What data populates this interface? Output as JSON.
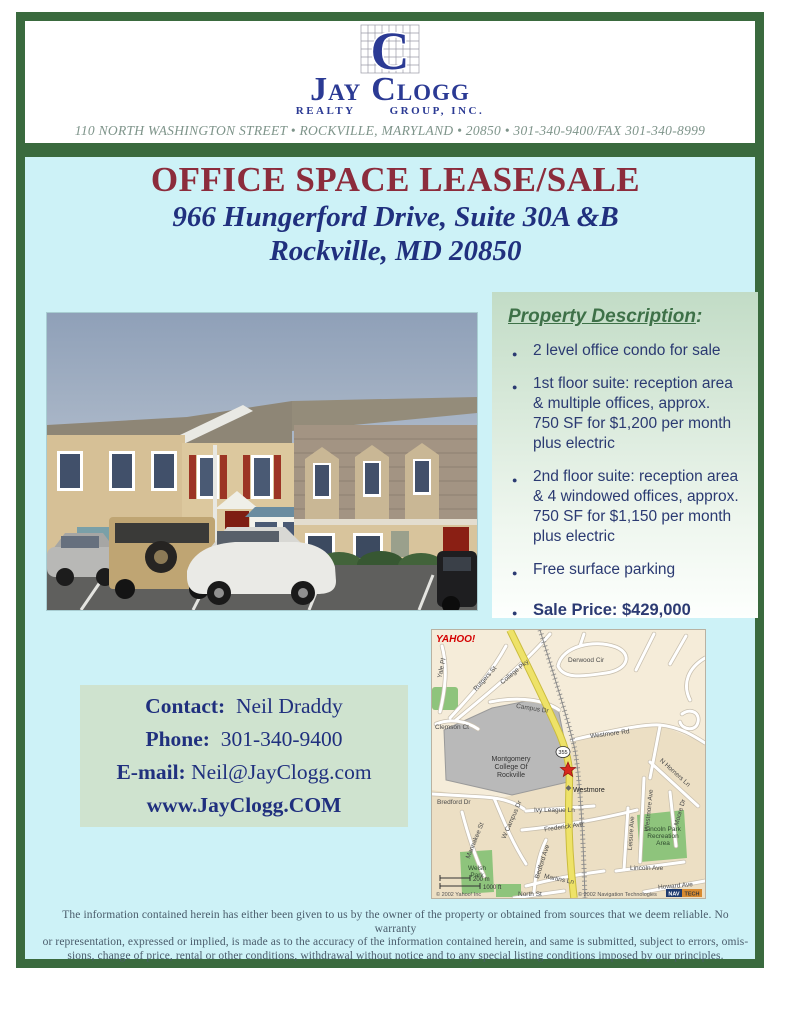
{
  "theme": {
    "frame_green": "#3a6a3e",
    "content_cyan": "#cdf2f7",
    "title_maroon": "#8c2c3c",
    "navy": "#20307e",
    "bullet_navy": "#2b3a72",
    "heading_green": "#3e7148",
    "panel_green_top": "#c2dcc6",
    "contact_bg": "#cfe3cf",
    "address_gray": "#7e948a",
    "disclaimer_slate": "#4a5c6b",
    "logo_navy": "#2b3a94"
  },
  "header": {
    "logo": {
      "monogram": "C",
      "name": {
        "j": "J",
        "ay": "AY",
        "c": "C",
        "logg": "LOGG"
      },
      "sub_left": "REALTY",
      "sub_right": "GROUP, INC."
    },
    "address_line": "110 NORTH WASHINGTON STREET • ROCKVILLE, MARYLAND • 20850 • 301-340-9400/FAX 301-340-8999"
  },
  "hero": {
    "title": "OFFICE SPACE LEASE/SALE",
    "subtitle1": "966 Hungerford Drive, Suite 30A &B",
    "subtitle2": "Rockville, MD  20850"
  },
  "property": {
    "heading": "Property Description",
    "heading_suffix": ":",
    "bullets": [
      "2 level office condo for sale",
      "1st floor suite: reception area & multiple offices, approx. 750 SF for $1,200 per month plus electric",
      "2nd floor suite: reception area & 4 windowed offices, approx. 750 SF for $1,150 per month plus electric",
      "Free surface parking"
    ],
    "sale_bullet": "Sale Price: $429,000"
  },
  "contact": {
    "rows": [
      {
        "label": "Contact:",
        "value": "Neil Draddy"
      },
      {
        "label": "Phone:",
        "value": "301-340-9400"
      },
      {
        "label": "E-mail:",
        "value": "Neil@JayClogg.com"
      }
    ],
    "website": "www.JayClogg.COM"
  },
  "map": {
    "provider": "YAHOO!",
    "route_shield": "355",
    "labels": {
      "yale_pl": "Yale Pl",
      "rutgers_st": "Rutgers St",
      "college_pky": "College Pky",
      "derwood_cir": "Derwood Cir",
      "clemson_ct": "Clemson Ct",
      "campus_dr": "Campus Dr",
      "westmore_rd": "Westmore Rd",
      "college_1": "Montgomery",
      "college_2": "College Of",
      "college_3": "Rockville",
      "westmore": "Westmore",
      "bredford_dr": "Bredford Dr",
      "ivy_league_ln": "Ivy League Ln",
      "frederick_ave": "Frederick Ave",
      "mannakee_st": "Mannakee St",
      "w_campus_dr": "W Campus Dr",
      "bedford_ave": "Bedford Ave",
      "martins_ln": "Martins Ln",
      "n_horners_ln": "N Horners Ln",
      "westmore_ave": "Westmore Ave",
      "leisure_ave": "Leisure Ave",
      "moore_dr": "Moore Dr",
      "lincoln_park_1": "Lincoln Park",
      "lincoln_park_2": "Recreation",
      "lincoln_park_3": "Area",
      "lincoln_ave": "Lincoln Ave",
      "welsh_park_1": "Welsh",
      "welsh_park_2": "Park",
      "north_st": "North St",
      "howard_ave": "Howard Ave"
    },
    "scale_m": "200 m",
    "scale_ft": "1000 ft",
    "copyright_left": "© 2002 Yahoo! Inc",
    "copyright_right": "© 2002 Navigation Technologies",
    "navtech": {
      "nav": "NAV",
      "tech": "TECH"
    }
  },
  "footer": {
    "lines": [
      "The information contained herein has either been given to us by the owner of the property or obtained from sources that we deem reliable.  No warranty",
      "or representation, expressed or implied, is made as to the accuracy of the information contained herein, and same is submitted, subject to errors, omis-",
      "sions, change of price, rental or other conditions, withdrawal without notice and to any special listing conditions imposed by our principles."
    ]
  }
}
